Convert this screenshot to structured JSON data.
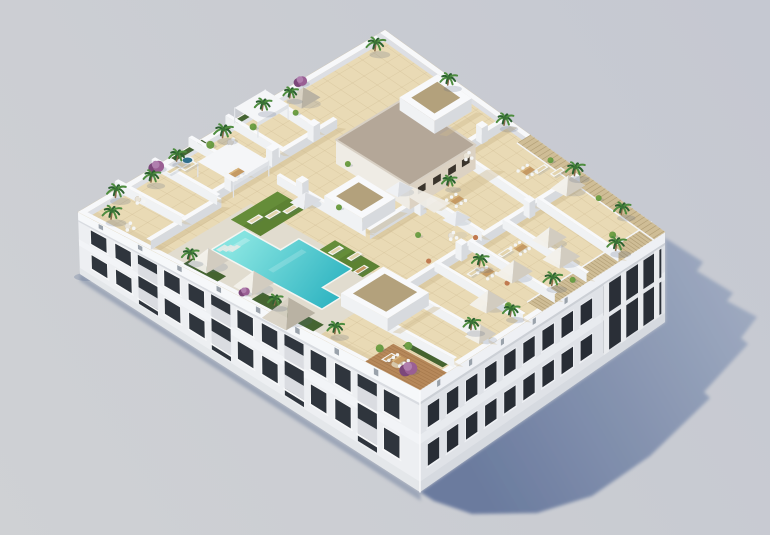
{
  "scene": {
    "type": "architectural-3d-render",
    "description": "Photorealistic aerial 3D rendering of a white Mediterranean apartment block seen from above its south corner. The rooftop holds a communal terrace with an L-shaped turquoise pool, artificial lawns with sun loungers, white and greige parasols, private walled terraces with dining sets, wood pergola slats along the right edges, palm trees and bougainvillea planters. Strong sunlight from the upper left casts a long blue-grey shadow onto the neutral grey ground at the lower right.",
    "view": "aerial axonometric",
    "lighting": {
      "sun_direction": "upper-left",
      "shadow_direction": "lower-right"
    },
    "building": {
      "kind": "residential apartment block",
      "floors_below_roof": 2,
      "left_facade": {
        "window_bays": 13,
        "balcony_bays": 4
      },
      "right_facade": {
        "window_bays": 9,
        "colonnade_pillars": 4
      },
      "rooftop_zones": [
        "private terraces",
        "communal pool deck",
        "lawn sunbathing areas",
        "stair core",
        "pergola terraces"
      ]
    },
    "inventory": {
      "swimming_pool": 1,
      "pool_shape": "L-shaped",
      "palm_trees": 21,
      "bougainvillea_shrubs": 4,
      "green_shrubs": 13,
      "parasols": 10,
      "skylight_pyramids": 3,
      "roof_lightwells": 3,
      "sun_loungers": 13,
      "dining_sets": 6,
      "bistro_sets": 5,
      "poufs": 3,
      "outdoor_rugs": 2,
      "privacy_walls": 19,
      "chimney_stacks": 8,
      "shade_canopies": 2,
      "jacuzzi": 1
    },
    "colors": {
      "bg_left": "#cfd1d4",
      "bg_right": "#c5c8d1",
      "shadow_near": "#66779c",
      "shadow_far": "#9fabc1",
      "contact_shadow": "#6e7f9d",
      "facade_lit": "#edeff2",
      "facade_lit_top": "#f6f8fa",
      "facade_lit_band": "#f2f4f7",
      "facade_lit_base": "#e4e7ea",
      "facade_shade": "#dfe2e7",
      "facade_shade_top": "#eef0f4",
      "facade_shade_band": "#e8ebef",
      "facade_shade_base": "#d6dae0",
      "window_dark": "#2f353d",
      "window_dark2": "#282d35",
      "frame": "#f8f9fa",
      "railing": "#e7eaee",
      "parapet_top": "#f7f8fa",
      "parapet_inner": "#dddfe4",
      "tile": "#e9dab5",
      "tile_line": "#d2bf97",
      "tile_shade": "#d8c69f",
      "pool_deck": "#e0dcd1",
      "wall_face_se": "#d7dade",
      "wall_face_sw": "#f0f2f4",
      "wall_top": "#f8f9fb",
      "wall_shadow": "#cdb98e",
      "pool_light": "#85e3e0",
      "pool_deep": "#2bb2c0",
      "pool_coping": "#f4f5f2",
      "grass": "#5d8233",
      "grass_light": "#76a344",
      "hedge": "#3c5d28",
      "palm_dark": "#2c6030",
      "palm_light": "#4d8c3e",
      "bush": "#699b45",
      "trunk": "#8a6b4a",
      "bougainvillea": "#9a5f94",
      "bougainvillea_dark": "#7c477a",
      "wood": "#b6885a",
      "wood_line": "#9c6f43",
      "slat": "#cfbd96",
      "slat_line": "#ad9a71",
      "canopy_white": "#f2f0ea",
      "canopy_white_shade": "#d2ccc0",
      "canopy_greige": "#d8d2c5",
      "canopy_greige_shade": "#b9b2a3",
      "core_roof": "#b4a798",
      "core_roof_edge": "#d8d0c4",
      "core_wall": "#dcd2c3",
      "core_wall_lit": "#efece5",
      "core_window": "#3a342c",
      "furn_white": "#f4f5f4",
      "furn_tan": "#c59a63",
      "furn_tan_top": "#d8b57d",
      "lounger_mat": "#e3d4ae",
      "pouf": "#c07a50",
      "rug": "#dccfb2",
      "jacuzzi_rim": "#eef0f0",
      "jacuzzi_water": "#2f6f8c",
      "lightwell_inner": "#b3a17c",
      "nub": "#9aa2ab",
      "pyr_nw": "#f6f7f9",
      "pyr_ne": "#e8eaed",
      "pyr_se": "#d9dce1",
      "pyr_sw": "#eff1f4"
    }
  }
}
